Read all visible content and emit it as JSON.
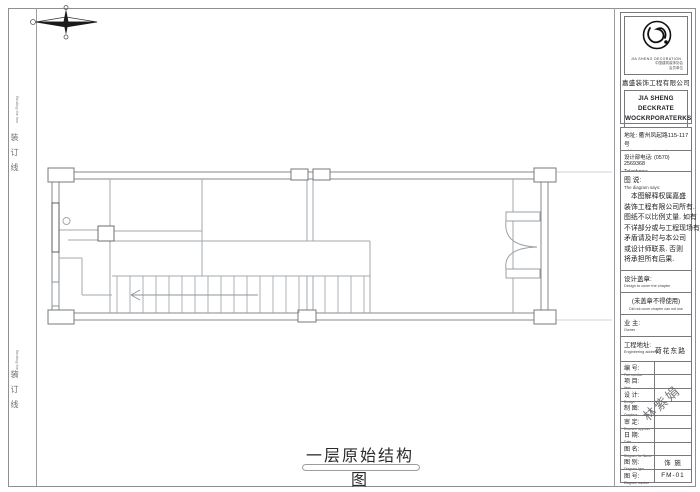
{
  "page": {
    "title": "一层原始结构图",
    "binding_cn": "装订线",
    "binding_en": "Binding the line"
  },
  "colors": {
    "plan_line": "#9aa0a5",
    "border_ink": "#76797d",
    "compass_ink": "#1a1a1a"
  },
  "titleblock": {
    "logo": {
      "caption": "JIA SHENG DECORATION",
      "tiny_line1": "中国建筑装饰协会",
      "tiny_line2": "会员单位",
      "company_cn": "嘉盛装饰工程有限公司",
      "brand_en1": "JIA SHENG DECKRATE",
      "brand_en2": "WOCKRPORATERKS"
    },
    "address_cn": "地址: 衢州凤起路115-117号",
    "address_en": "Address Feng Qi Road No.115-117",
    "phone_cn": "设计部电话: (0570) 2569368",
    "phone_en": "Telephone:",
    "notes": {
      "title_cn": "图 说:",
      "title_en": "The diagram says:",
      "lines": [
        "　本图解释权属嘉盛",
        "装饰工程有限公司所有.",
        "图纸不以比例丈量. 如有",
        "不详部分或与工程现场有",
        "矛盾请及时与本公司",
        "或设计师联系. 否则",
        "将承担所有后果."
      ]
    },
    "stamp": {
      "label_cn": "设计盖章:",
      "label_en": "Design to cover the chapter",
      "warn_cn": "(未盖章不得使用)",
      "warn_en": "Did not cover chapter can not use"
    },
    "owner": {
      "label_cn": "业 主:",
      "label_en": "Owner",
      "value": ""
    },
    "site": {
      "label_cn": "工程地址:",
      "label_en": "Engineering address",
      "value": "荷花东路"
    },
    "rows": [
      {
        "cn": "编 号:",
        "en": "Part number",
        "value": ""
      },
      {
        "cn": "项 目:",
        "en": "Item",
        "value": ""
      },
      {
        "cn": "设 计:",
        "en": "Design",
        "value": ""
      },
      {
        "cn": "制 图:",
        "en": "Graphics",
        "value": ""
      },
      {
        "cn": "审 定:",
        "en": "Examine approve",
        "value": ""
      },
      {
        "cn": "日 期:",
        "en": "Date",
        "value": ""
      },
      {
        "cn": "图 名:",
        "en": "Diagram for Name",
        "value": ""
      },
      {
        "cn": "图 别:",
        "en": "Diagram type",
        "value": "饰 施"
      },
      {
        "cn": "图 号:",
        "en": "Diagram number",
        "value": "FM-01"
      }
    ],
    "watermark": "林紫娟"
  }
}
